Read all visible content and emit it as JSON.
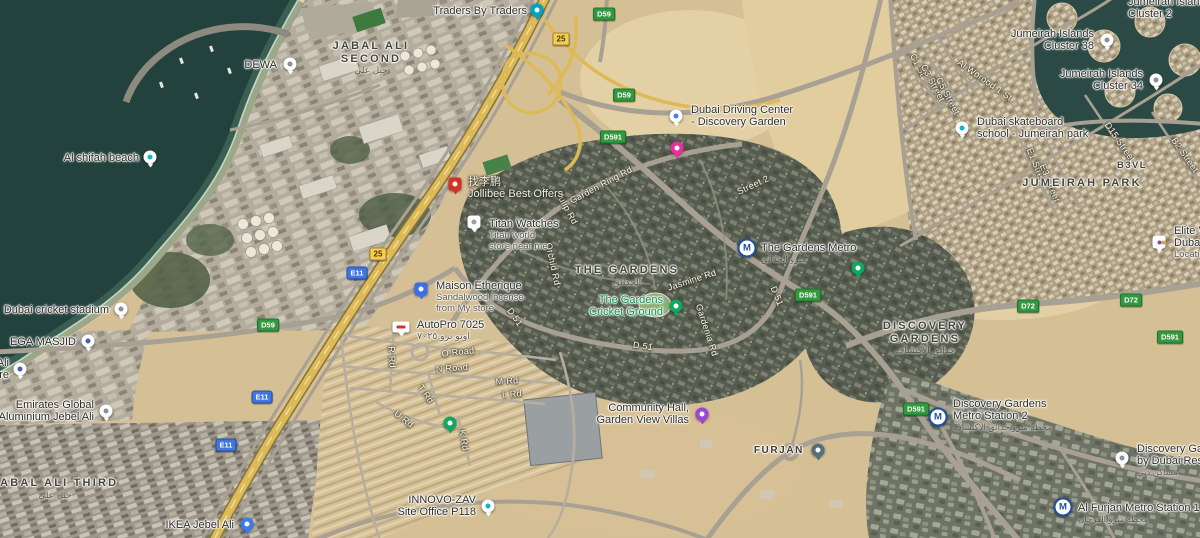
{
  "palette": {
    "sand": "#d5c096",
    "water": "#24423d",
    "highway": "#ddb957",
    "road": "#a8a092",
    "route_green": "#33993f",
    "route_blue": "#3f76e0",
    "exit_yellow": "#f6cd4f",
    "park_label_green": "#0b8f4d",
    "metro_navy": "#20519c"
  },
  "map": {
    "districts": [
      {
        "id": "jabal-ali-second",
        "lines": [
          "JABAL ALI",
          "SECOND"
        ],
        "arabic": "جبل علي",
        "x": 371,
        "y": 40
      },
      {
        "id": "jabal-ali-third",
        "lines": [
          "JABAL ALI THIRD"
        ],
        "arabic": "جبل علي",
        "x": 55,
        "y": 477
      },
      {
        "id": "the-gardens",
        "lines": [
          "THE GARDENS"
        ],
        "arabic": "الحدائق",
        "x": 627,
        "y": 264
      },
      {
        "id": "discovery-gardens",
        "lines": [
          "DISCOVERY",
          "GARDENS"
        ],
        "arabic": "حدائق الاكتشاف",
        "x": 925,
        "y": 320
      },
      {
        "id": "jumeirah-park",
        "lines": [
          "JUMEIRAH PARK"
        ],
        "x": 1082,
        "y": 177
      },
      {
        "id": "b3vl",
        "lines": [
          "B3VL"
        ],
        "x": 1132,
        "y": 160,
        "small": true
      }
    ],
    "route_markers": [
      {
        "label": "D59",
        "kind": "d",
        "x": 604,
        "y": 14
      },
      {
        "label": "D59",
        "kind": "d",
        "x": 624,
        "y": 95
      },
      {
        "label": "D591",
        "kind": "d",
        "x": 613,
        "y": 137
      },
      {
        "label": "D59",
        "kind": "d",
        "x": 268,
        "y": 325
      },
      {
        "label": "D591",
        "kind": "d",
        "x": 808,
        "y": 295
      },
      {
        "label": "D591",
        "kind": "d",
        "x": 916,
        "y": 409
      },
      {
        "label": "D591",
        "kind": "d",
        "x": 1170,
        "y": 337
      },
      {
        "label": "D72",
        "kind": "d",
        "x": 1028,
        "y": 306
      },
      {
        "label": "D72",
        "kind": "d",
        "x": 1131,
        "y": 300
      },
      {
        "label": "E11",
        "kind": "e",
        "x": 357,
        "y": 273
      },
      {
        "label": "E11",
        "kind": "e",
        "x": 262,
        "y": 397
      },
      {
        "label": "E11",
        "kind": "e",
        "x": 226,
        "y": 445
      },
      {
        "label": "25",
        "kind": "exit",
        "x": 561,
        "y": 39
      },
      {
        "label": "25",
        "kind": "exit",
        "x": 378,
        "y": 254
      }
    ],
    "road_labels": [
      {
        "t": "Garden Ring Rd",
        "x": 601,
        "y": 185,
        "r": -28
      },
      {
        "t": "Street 2",
        "x": 753,
        "y": 185,
        "r": -25
      },
      {
        "t": "Tulip Rd",
        "x": 567,
        "y": 208,
        "r": 62
      },
      {
        "t": "Orchid Rd",
        "x": 553,
        "y": 264,
        "r": 78
      },
      {
        "t": "Jasmine Rd",
        "x": 692,
        "y": 280,
        "r": -18
      },
      {
        "t": "Gardenia Rd",
        "x": 707,
        "y": 330,
        "r": 72
      },
      {
        "t": "D 51",
        "x": 777,
        "y": 296,
        "r": 68
      },
      {
        "t": "D 51",
        "x": 643,
        "y": 346,
        "r": 8
      },
      {
        "t": "D 51",
        "x": 515,
        "y": 317,
        "r": 55
      },
      {
        "t": "O Road",
        "x": 458,
        "y": 352,
        "r": -6
      },
      {
        "t": "N Road",
        "x": 452,
        "y": 368,
        "r": -4
      },
      {
        "t": "M Rd",
        "x": 507,
        "y": 381,
        "r": -4
      },
      {
        "t": "L Rd",
        "x": 512,
        "y": 394,
        "r": -4
      },
      {
        "t": "T Rd",
        "x": 426,
        "y": 394,
        "r": 55
      },
      {
        "t": "U Rd",
        "x": 404,
        "y": 419,
        "r": 38
      },
      {
        "t": "K Rd",
        "x": 464,
        "y": 440,
        "r": 80
      },
      {
        "t": "R Rd",
        "x": 392,
        "y": 357,
        "r": 86
      },
      {
        "t": "C1 St",
        "x": 918,
        "y": 65,
        "r": 62
      },
      {
        "t": "C3 Street",
        "x": 933,
        "y": 83,
        "r": 62
      },
      {
        "t": "C5 Street",
        "x": 948,
        "y": 96,
        "r": 62
      },
      {
        "t": "Al Worood 1 St",
        "x": 985,
        "y": 80,
        "r": 35
      },
      {
        "t": "E1 Street",
        "x": 1037,
        "y": 167,
        "r": 68
      },
      {
        "t": "E3 Street",
        "x": 1050,
        "y": 183,
        "r": 68
      },
      {
        "t": "D15 Street",
        "x": 1120,
        "y": 142,
        "r": 55
      },
      {
        "t": "B2 Street",
        "x": 1185,
        "y": 155,
        "r": 55
      }
    ],
    "pois": [
      {
        "id": "traders-by-traders",
        "lines": [
          "Traders By Traders"
        ],
        "pin": {
          "x": 537,
          "y": 10,
          "shape": "circle",
          "bg": "#00a3c0",
          "dot": "#ffffff"
        },
        "text": {
          "x": 527,
          "y": 11,
          "align": "end"
        }
      },
      {
        "id": "dewa",
        "lines": [
          "DEWA"
        ],
        "pin": {
          "x": 290,
          "y": 64,
          "shape": "circle",
          "bg": "#ffffff",
          "dot": "#8a8f98"
        },
        "text": {
          "x": 277,
          "y": 65,
          "align": "end"
        }
      },
      {
        "id": "al-shifah-beach",
        "lines": [
          "Al shifah beach"
        ],
        "pin": {
          "x": 150,
          "y": 157,
          "shape": "circle",
          "bg": "#ffffff",
          "dot": "#12b5cb"
        },
        "text": {
          "x": 139,
          "y": 158,
          "align": "end"
        }
      },
      {
        "id": "dubai-cricket-stadium",
        "lines": [
          "Dubai cricket stadium"
        ],
        "pin": {
          "x": 121,
          "y": 309,
          "shape": "circle",
          "bg": "#ffffff",
          "dot": "#8a8f98"
        },
        "text": {
          "x": 109,
          "y": 310,
          "align": "end"
        }
      },
      {
        "id": "ega-masjid",
        "lines": [
          "EGA MASJID"
        ],
        "pin": {
          "x": 88,
          "y": 341,
          "shape": "circle",
          "bg": "#ffffff",
          "dot": "#4a5fb0"
        },
        "text": {
          "x": 76,
          "y": 342,
          "align": "end"
        }
      },
      {
        "id": "clipped-left-poi",
        "lines": [
          "Ali",
          "re"
        ],
        "pin": {
          "x": 20,
          "y": 369,
          "shape": "circle",
          "bg": "#ffffff",
          "dot": "#4a5fb0"
        },
        "text": {
          "x": 9,
          "y": 363,
          "align": "end"
        }
      },
      {
        "id": "emirates-global-aluminium",
        "lines": [
          "Emirates Global",
          "Aluminium Jebel Ali"
        ],
        "pin": {
          "x": 106,
          "y": 411,
          "shape": "circle",
          "bg": "#ffffff",
          "dot": "#8a8f98"
        },
        "text": {
          "x": 94,
          "y": 405,
          "align": "end"
        }
      },
      {
        "id": "ikea-jebel-ali",
        "lines": [
          "IKEA Jebel Ali"
        ],
        "pin": {
          "x": 247,
          "y": 524,
          "shape": "circle",
          "bg": "#3b7de8",
          "dot": "#ffffff"
        },
        "text": {
          "x": 234,
          "y": 525,
          "align": "end"
        }
      },
      {
        "id": "innovo-zav-site-office",
        "lines": [
          "INNOVO-ZAV",
          "Site Office P118"
        ],
        "pin": {
          "x": 488,
          "y": 506,
          "shape": "circle",
          "bg": "#ffffff",
          "dot": "#12b5cb"
        },
        "text": {
          "x": 476,
          "y": 500,
          "align": "end"
        }
      },
      {
        "id": "community-hall-gardenview",
        "lines": [
          "Community Hall,",
          "Garden View Villas"
        ],
        "pin": {
          "x": 702,
          "y": 414,
          "shape": "circle",
          "bg": "#9d45d6",
          "dot": "#ffffff"
        },
        "text": {
          "x": 689,
          "y": 408,
          "align": "end"
        }
      },
      {
        "id": "furjan",
        "lines": [
          "FURJAN"
        ],
        "style": "spaced",
        "pin": {
          "x": 818,
          "y": 450,
          "shape": "circle",
          "bg": "#546e7a",
          "dot": "#ffffff"
        },
        "text": {
          "x": 804,
          "y": 451,
          "align": "end"
        }
      },
      {
        "id": "dubai-driving-center",
        "lines": [
          "Dubai Driving Center",
          "- Discovery Garden"
        ],
        "pin": {
          "x": 676,
          "y": 116,
          "shape": "circle",
          "bg": "#ffffff",
          "dot": "#4285f4"
        },
        "text": {
          "x": 691,
          "y": 110,
          "align": "start"
        }
      },
      {
        "id": "pink-poi-pin",
        "lines": [],
        "pin": {
          "x": 677,
          "y": 148,
          "shape": "circle",
          "bg": "#ec2e9b",
          "dot": "#ffffff"
        }
      },
      {
        "id": "jollibee-best-offers",
        "lines": [
          "找李鹏",
          "Jollibee Best Offers"
        ],
        "style": "light",
        "pin": {
          "x": 455,
          "y": 184,
          "shape": "square",
          "bg": "#d93025",
          "dot": "#ffffff"
        },
        "text": {
          "x": 468,
          "y": 182,
          "align": "start"
        }
      },
      {
        "id": "titan-watches",
        "lines": [
          "Titan Watches"
        ],
        "sub": [
          "Titan world",
          "store near me"
        ],
        "pin": {
          "x": 474,
          "y": 222,
          "shape": "square",
          "bg": "#ffffff",
          "dot": "#9aa0a6"
        },
        "text": {
          "x": 489,
          "y": 224,
          "align": "start"
        }
      },
      {
        "id": "maison-etherique",
        "lines": [
          "Maison Etherique"
        ],
        "sub": [
          "Sandalwood incense",
          "from My store"
        ],
        "pin": {
          "x": 421,
          "y": 289,
          "shape": "square",
          "bg": "#3a6fe8",
          "dot": "#ffffff"
        },
        "text": {
          "x": 436,
          "y": 286,
          "align": "start"
        }
      },
      {
        "id": "autopro-7025",
        "lines": [
          "AutoPro  7025"
        ],
        "sub": [
          "اوتو برو ٧٠٢٥"
        ],
        "pin": {
          "x": 401,
          "y": 327,
          "shape": "rect",
          "bg": "#ffffff",
          "dot": "#d93025"
        },
        "text": {
          "x": 417,
          "y": 325,
          "align": "start"
        }
      },
      {
        "id": "gardens-cricket-ground",
        "lines": [
          "The Gardens",
          "Cricket Ground"
        ],
        "style": "green",
        "pin": {
          "x": 676,
          "y": 306,
          "shape": "circle",
          "bg": "#0fa861",
          "dot": "#ffffff"
        },
        "text": {
          "x": 663,
          "y": 300,
          "align": "end"
        }
      },
      {
        "id": "the-gardens-metro",
        "lines": [
          "The Gardens Metro"
        ],
        "arabic": "مترو الحدائق",
        "pin": {
          "x": 747,
          "y": 248,
          "shape": "metro"
        },
        "text": {
          "x": 761,
          "y": 248,
          "align": "start"
        }
      },
      {
        "id": "park-pin-gardens-east",
        "lines": [],
        "pin": {
          "x": 858,
          "y": 268,
          "shape": "circle",
          "bg": "#0fa861",
          "dot": "#ffffff"
        }
      },
      {
        "id": "park-pin-villas",
        "lines": [],
        "pin": {
          "x": 450,
          "y": 423,
          "shape": "circle",
          "bg": "#0fa861",
          "dot": "#ffffff"
        }
      },
      {
        "id": "jumeirah-islands-cluster-38",
        "lines": [
          "Jumeirah Islands",
          "Cluster 38"
        ],
        "pin": {
          "x": 1107,
          "y": 40,
          "shape": "circle",
          "bg": "#ffffff",
          "dot": "#8a8f98"
        },
        "text": {
          "x": 1094,
          "y": 34,
          "align": "end"
        }
      },
      {
        "id": "jumeirah-islands-cluster-34",
        "lines": [
          "Jumeirah Islands",
          "Cluster 34"
        ],
        "pin": {
          "x": 1156,
          "y": 80,
          "shape": "circle",
          "bg": "#ffffff",
          "dot": "#8a8f98"
        },
        "text": {
          "x": 1143,
          "y": 74,
          "align": "end"
        }
      },
      {
        "id": "dubai-skateboard-school",
        "lines": [
          "Dubai skateboard",
          "school - Jumeirah park"
        ],
        "pin": {
          "x": 962,
          "y": 128,
          "shape": "circle",
          "bg": "#ffffff",
          "dot": "#12b5cb"
        },
        "text": {
          "x": 977,
          "y": 122,
          "align": "start"
        }
      },
      {
        "id": "elite-clipped",
        "lines": [
          "Elite V",
          "Duba"
        ],
        "sub": [
          "Locatio"
        ],
        "pin": {
          "x": 1159,
          "y": 242,
          "shape": "square",
          "bg": "#ffffff",
          "dot": "#8e44ad"
        },
        "text": {
          "x": 1174,
          "y": 231,
          "align": "start"
        }
      },
      {
        "id": "discovery-gardens-metro-2",
        "lines": [
          "Discovery Gardens",
          "Metro Station 2"
        ],
        "arabic": "محطة مترو حدائق الاكتشاف",
        "pin": {
          "x": 938,
          "y": 417,
          "shape": "metro"
        },
        "text": {
          "x": 953,
          "y": 404,
          "align": "start"
        }
      },
      {
        "id": "discovery-gardens-residence-clipped",
        "lines": [
          "Discovery Gard",
          "by Dubai Resid"
        ],
        "arabic": "مساكن دبي",
        "pin": {
          "x": 1122,
          "y": 458,
          "shape": "circle",
          "bg": "#ffffff",
          "dot": "#8a8f98"
        },
        "text": {
          "x": 1137,
          "y": 449,
          "align": "start"
        }
      },
      {
        "id": "al-furjan-metro-1",
        "lines": [
          "Al Furjan Metro Station 1"
        ],
        "arabic": "محطة مترو الفرجان",
        "pin": {
          "x": 1063,
          "y": 507,
          "shape": "metro"
        },
        "text": {
          "x": 1078,
          "y": 508,
          "align": "start"
        }
      },
      {
        "id": "jumeirah-islands-cluster-2-clipped",
        "lines": [
          "Jumeirah Islands",
          "Cluster 2"
        ],
        "text": {
          "x": 1128,
          "y": 2,
          "align": "start"
        }
      }
    ]
  }
}
